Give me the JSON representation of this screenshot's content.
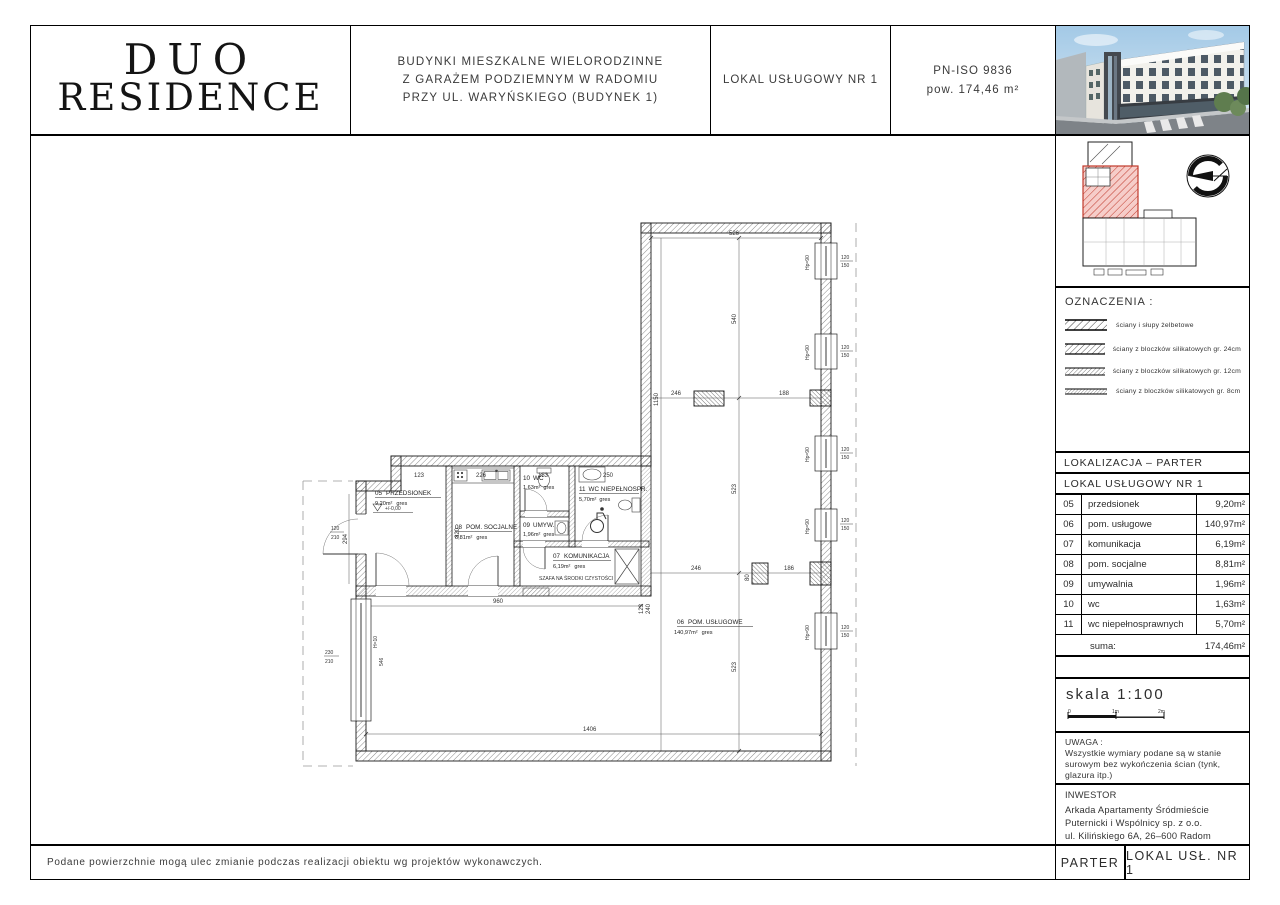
{
  "header": {
    "logo_line1": "DUO",
    "logo_line2": "RESIDENCE",
    "project_line1": "BUDYNKI MIESZKALNE WIELORODZINNE",
    "project_line2": "Z GARAŻEM PODZIEMNYM W RADOMIU",
    "project_line3": "PRZY UL. WARYŃSKIEGO (BUDYNEK 1)",
    "unit_title": "LOKAL USŁUGOWY NR 1",
    "standard": "PN-ISO 9836",
    "area": "pow. 174,46 m²"
  },
  "sidebar": {
    "legend_title": "OZNACZENIA :",
    "legend_items": [
      "ściany i słupy żelbetowe",
      "ściany z bloczków silikatowych gr. 24cm",
      "ściany z bloczków silikatowych gr. 12cm",
      "ściany z bloczków silikatowych gr. 8cm"
    ],
    "localization": "LOKALIZACJA – PARTER",
    "unit": "LOKAL USŁUGOWY NR 1",
    "rooms": [
      {
        "no": "05",
        "name": "przedsionek",
        "area": "9,20m²"
      },
      {
        "no": "06",
        "name": "pom. usługowe",
        "area": "140,97m²"
      },
      {
        "no": "07",
        "name": "komunikacja",
        "area": "6,19m²"
      },
      {
        "no": "08",
        "name": "pom. socjalne",
        "area": "8,81m²"
      },
      {
        "no": "09",
        "name": "umywalnia",
        "area": "1,96m²"
      },
      {
        "no": "10",
        "name": "wc",
        "area": "1,63m²"
      },
      {
        "no": "11",
        "name": "wc niepełnosprawnych",
        "area": "5,70m²"
      }
    ],
    "suma_label": "suma:",
    "suma_value": "174,46m²",
    "scale": "skala 1:100",
    "scale_t0": "0",
    "scale_t1": "1m",
    "scale_t2": "2m",
    "uwaga_title": "UWAGA :",
    "uwaga_l1": "Wszystkie wymiary podane są w  stanie",
    "uwaga_l2": "surowym bez wykończenia  ścian (tynk,",
    "uwaga_l3": "glazura itp.)",
    "investor_title": "INWESTOR",
    "investor_l1": "Arkada Apartamenty Śródmieście",
    "investor_l2": "Puternicki i Wspólnicy sp. z o.o.",
    "investor_l3": "ul. Kilińskiego 6A, 26–600 Radom",
    "storey": "PARTER",
    "unit_short": "LOKAL USŁ. NR 1"
  },
  "footer_note": "Podane powierzchnie mogą ulec zmianie podczas realizacji obiektu wg projektów wykonawczych.",
  "plan": {
    "rooms": [
      {
        "no": "05",
        "name": "PRZEDSIONEK",
        "area": "9,20m²",
        "floor": "gres"
      },
      {
        "no": "06",
        "name": "POM. USŁUGOWE",
        "area": "140,97m²",
        "floor": "gres"
      },
      {
        "no": "07",
        "name": "KOMUNIKACJA",
        "area": "6,19m²",
        "floor": "gres"
      },
      {
        "no": "08",
        "name": "POM. SOCJALNE",
        "area": "8,81m²",
        "floor": "gres"
      },
      {
        "no": "09",
        "name": "UMYW.",
        "area": "1,96m²",
        "floor": "gres"
      },
      {
        "no": "10",
        "name": "WC",
        "area": "1,63m²",
        "floor": "gres"
      },
      {
        "no": "11",
        "name": "WC NIEPEŁNOSPR.",
        "area": "5,70m²",
        "floor": "gres"
      }
    ],
    "closet_note": "SZAFA NA ŚRODKI CZYSTOŚCI",
    "level": "+/-0,00",
    "dims": {
      "top": "526",
      "v1": "540",
      "v2": "523",
      "v3": "523",
      "left": "1150",
      "c1a": "246",
      "c1b": "188",
      "c2a": "246",
      "c2b": "186",
      "c2c": "80",
      "bottom": "1406",
      "strip": "960",
      "strip2": "123",
      "strip3": "240",
      "t05": "123",
      "t08": "226",
      "t10": "183",
      "t11": "250",
      "v05": "294",
      "v08": "320",
      "win_w": "120",
      "win_h": "150",
      "hp": "Hp=90",
      "door_w": "120",
      "door_h": "210",
      "lw_a": "230",
      "lw_b": "210",
      "lw_hp": "H=10",
      "lw_len": "546"
    }
  }
}
